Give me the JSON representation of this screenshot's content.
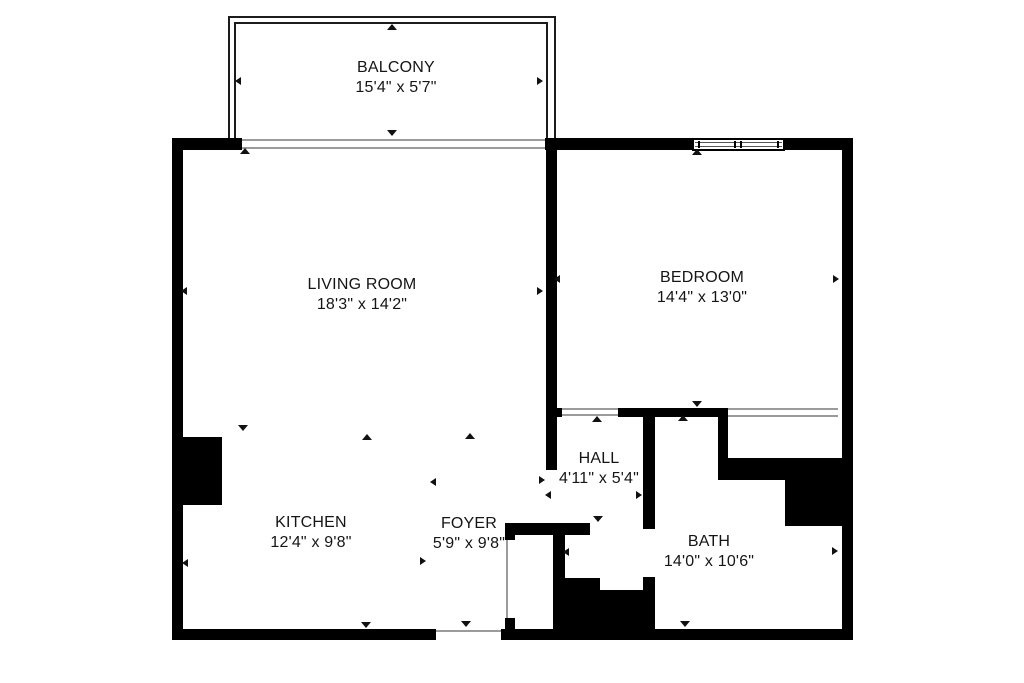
{
  "floorplan": {
    "background": "#ffffff",
    "wall_color": "#000000",
    "thin_line_color": "#9b9b9b",
    "text_color": "#151515",
    "rooms": [
      {
        "id": "balcony",
        "name": "BALCONY",
        "dimensions": "15'4\" x 5'7\"",
        "label_x": 396,
        "label_y": 58
      },
      {
        "id": "living-room",
        "name": "LIVING ROOM",
        "dimensions": "18'3\" x 14'2\"",
        "label_x": 362,
        "label_y": 275
      },
      {
        "id": "bedroom",
        "name": "BEDROOM",
        "dimensions": "14'4\" x 13'0\"",
        "label_x": 702,
        "label_y": 268
      },
      {
        "id": "hall",
        "name": "HALL",
        "dimensions": "4'11\" x 5'4\"",
        "label_x": 599,
        "label_y": 449
      },
      {
        "id": "kitchen",
        "name": "KITCHEN",
        "dimensions": "12'4\" x 9'8\"",
        "label_x": 311,
        "label_y": 513
      },
      {
        "id": "foyer",
        "name": "FOYER",
        "dimensions": "5'9\" x 9'8\"",
        "label_x": 469,
        "label_y": 514
      },
      {
        "id": "bath",
        "name": "BATH",
        "dimensions": "14'0\" x 10'6\"",
        "label_x": 709,
        "label_y": 532
      }
    ],
    "dimension_arrows": [
      {
        "x": 392,
        "y": 29,
        "dir": "up"
      },
      {
        "x": 240,
        "y": 82,
        "dir": "left"
      },
      {
        "x": 542,
        "y": 82,
        "dir": "right"
      },
      {
        "x": 392,
        "y": 135,
        "dir": "down"
      },
      {
        "x": 245,
        "y": 153,
        "dir": "up"
      },
      {
        "x": 186,
        "y": 292,
        "dir": "left"
      },
      {
        "x": 542,
        "y": 292,
        "dir": "right"
      },
      {
        "x": 243,
        "y": 430,
        "dir": "down"
      },
      {
        "x": 697,
        "y": 154,
        "dir": "up"
      },
      {
        "x": 559,
        "y": 280,
        "dir": "left"
      },
      {
        "x": 838,
        "y": 280,
        "dir": "right"
      },
      {
        "x": 697,
        "y": 406,
        "dir": "down"
      },
      {
        "x": 597,
        "y": 421,
        "dir": "up"
      },
      {
        "x": 550,
        "y": 496,
        "dir": "left"
      },
      {
        "x": 641,
        "y": 496,
        "dir": "right"
      },
      {
        "x": 598,
        "y": 521,
        "dir": "down"
      },
      {
        "x": 367,
        "y": 439,
        "dir": "up"
      },
      {
        "x": 187,
        "y": 564,
        "dir": "left"
      },
      {
        "x": 425,
        "y": 562,
        "dir": "right"
      },
      {
        "x": 366,
        "y": 627,
        "dir": "down"
      },
      {
        "x": 470,
        "y": 438,
        "dir": "up"
      },
      {
        "x": 435,
        "y": 483,
        "dir": "left"
      },
      {
        "x": 544,
        "y": 481,
        "dir": "right"
      },
      {
        "x": 466,
        "y": 626,
        "dir": "down"
      },
      {
        "x": 683,
        "y": 420,
        "dir": "up"
      },
      {
        "x": 568,
        "y": 553,
        "dir": "left"
      },
      {
        "x": 837,
        "y": 552,
        "dir": "right"
      },
      {
        "x": 685,
        "y": 626,
        "dir": "down"
      }
    ]
  }
}
